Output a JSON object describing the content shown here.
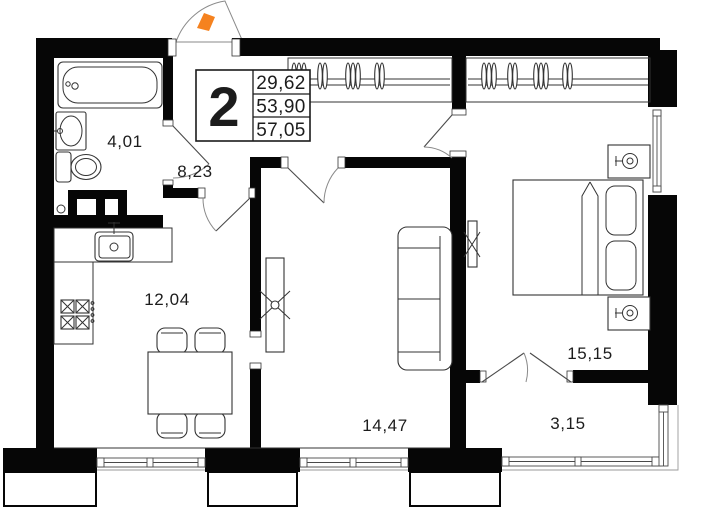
{
  "info_box": {
    "room_count": "2",
    "values": [
      "29,62",
      "53,90",
      "57,05"
    ]
  },
  "rooms": {
    "bathroom": {
      "area": "4,01"
    },
    "hallway": {
      "area": "8,23"
    },
    "kitchen": {
      "area": "12,04"
    },
    "living_room": {
      "area": "14,47"
    },
    "bedroom": {
      "area": "15,15"
    },
    "balcony": {
      "area": "3,15"
    }
  },
  "colors": {
    "wall": "#060606",
    "entry_marker": "#F5821F",
    "door_swing": "#ECECEC"
  }
}
